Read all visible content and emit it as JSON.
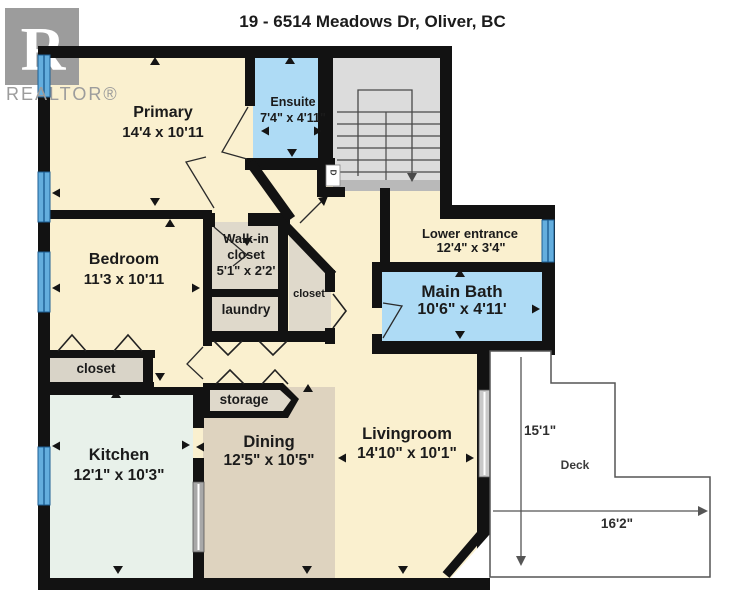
{
  "title": "19 - 6514 Meadows Dr, Oliver, BC",
  "logo": {
    "letter": "R",
    "brand": "REALTOR®"
  },
  "door_marker": "D",
  "rooms": {
    "primary": {
      "name": "Primary",
      "dims": "14'4 x 10'11"
    },
    "ensuite": {
      "name": "Ensuite",
      "dims": "7'4\" x 4'11\""
    },
    "bedroom": {
      "name": "Bedroom",
      "dims": "11'3 x 10'11"
    },
    "walkin": {
      "line1": "Walk-in",
      "line2": "closet",
      "dims": "5'1\" x 2'2'"
    },
    "laundry": {
      "name": "laundry"
    },
    "hall_closet": {
      "name": "closet"
    },
    "bedroom_closet": {
      "name": "closet"
    },
    "lower_entrance": {
      "name": "Lower entrance",
      "dims": "12'4\" x 3'4\""
    },
    "main_bath": {
      "name": "Main Bath",
      "dims": "10'6\" x 4'11'"
    },
    "storage": {
      "name": "storage"
    },
    "kitchen": {
      "name": "Kitchen",
      "dims": "12'1\" x 10'3\""
    },
    "dining": {
      "name": "Dining",
      "dims": "12'5\" x 10'5\""
    },
    "livingroom": {
      "name": "Livingroom",
      "dims": "14'10\" x 10'1\""
    },
    "deck": {
      "name": "Deck",
      "depth": "15'1\"",
      "width": "16'2\""
    }
  },
  "colors": {
    "floor_cream": "#FAF0CF",
    "room_blue": "#AEDBF5",
    "stairs_gray": "#DCDCDC",
    "closet_beige": "#DFD9CB",
    "kitchen_mint": "#E8F1EA",
    "dining_tan": "#DED3BF",
    "window_blue": "#64AEDE",
    "wall_black": "#121212",
    "logo_gray": "#9C9C9C"
  }
}
